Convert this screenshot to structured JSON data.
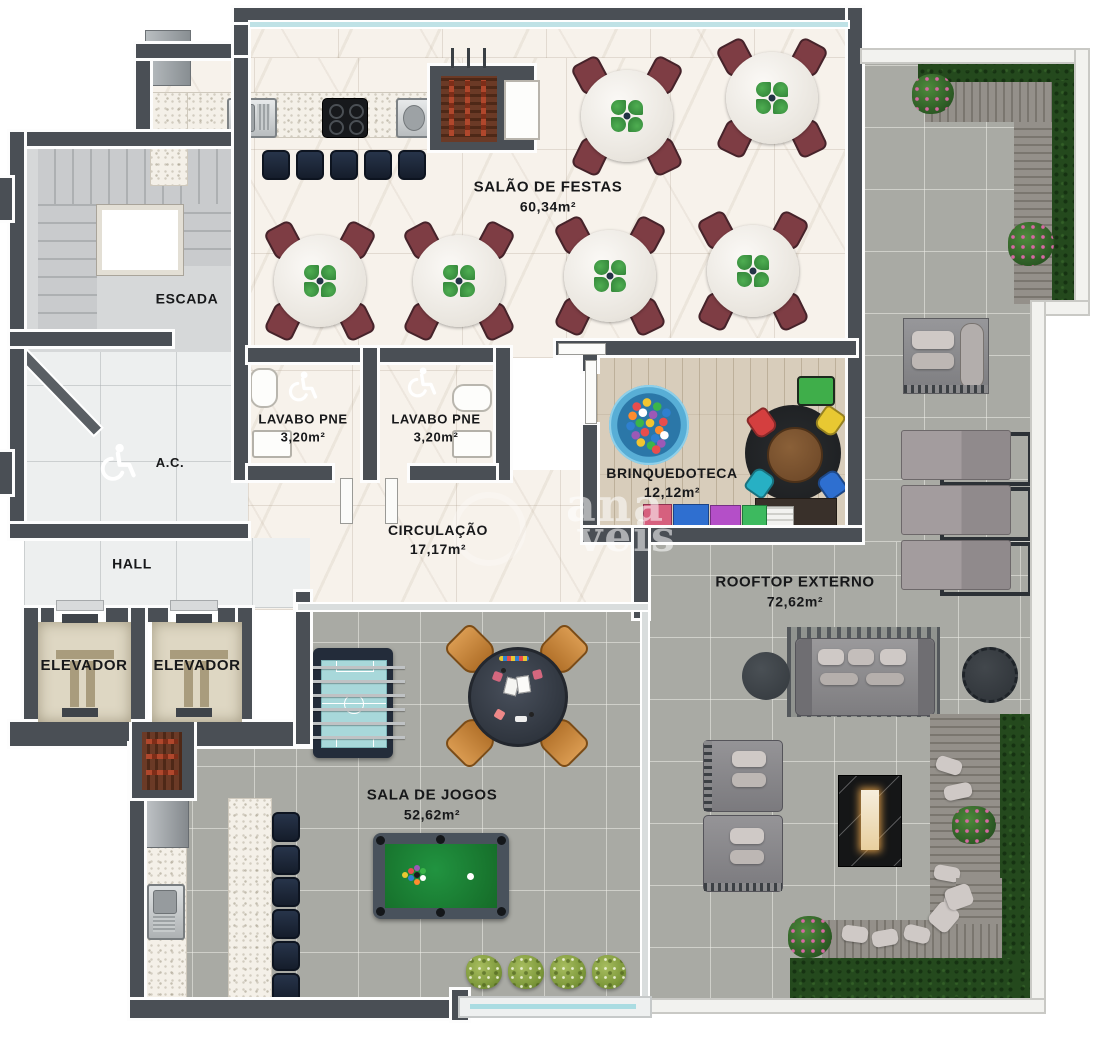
{
  "plan": {
    "rooms": {
      "salao": {
        "name": "SALÃO DE FESTAS",
        "area": "60,34m²"
      },
      "escada": {
        "name": "ESCADA"
      },
      "lavabo_pne_1": {
        "name": "LAVABO PNE",
        "area": "3,20m²"
      },
      "lavabo_pne_2": {
        "name": "LAVABO PNE",
        "area": "3,20m²"
      },
      "ac": {
        "name": "A.C."
      },
      "brinquedoteca": {
        "name": "BRINQUEDOTECA",
        "area": "12,12m²"
      },
      "circulacao": {
        "name": "CIRCULAÇÃO",
        "area": "17,17m²"
      },
      "hall": {
        "name": "HALL"
      },
      "elevador_1": {
        "name": "ELEVADOR"
      },
      "elevador_2": {
        "name": "ELEVADOR"
      },
      "rooftop": {
        "name": "ROOFTOP EXTERNO",
        "area": "72,62m²"
      },
      "sala_jogos": {
        "name": "SALA DE JOGOS",
        "area": "52,62m²"
      }
    },
    "watermark": {
      "fragment_top": "ana",
      "fragment_bottom": "veis"
    },
    "palette": {
      "wall": "#4a4f55",
      "marble": "#f7f2eb",
      "concrete": "#a9aaa4",
      "wood_floor": "#d8cdbb",
      "deck": "#8d8a82",
      "hedge": "#24491d",
      "pool_felt": "#1e7a31",
      "foosball_field": "#a8d8da",
      "dining_chair": "#7e3d44",
      "stool": "#1e2a3a",
      "elevator_cab": "#ded7c3"
    }
  }
}
